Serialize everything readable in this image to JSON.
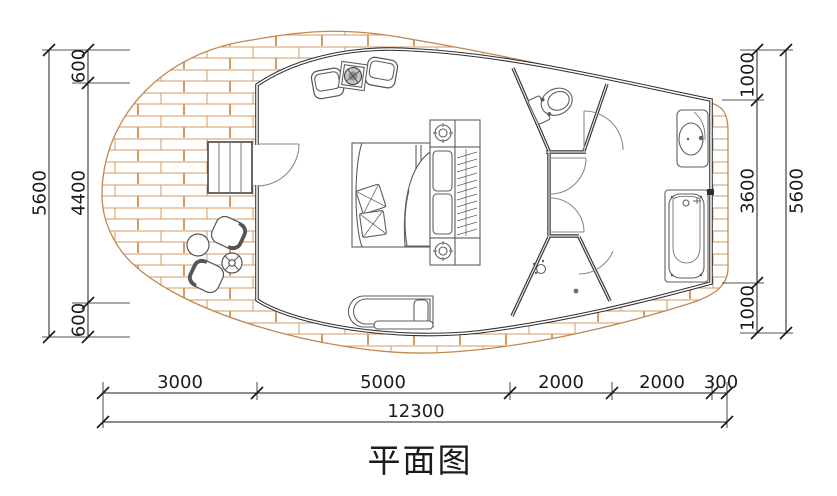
{
  "title": "平面图",
  "dimensions": {
    "left": {
      "overall": "5600",
      "segments": [
        "600",
        "4400",
        "600"
      ]
    },
    "right": {
      "overall": "5600",
      "segments": [
        "1000",
        "3600",
        "1000"
      ]
    },
    "bottom": {
      "overall": "12300",
      "segments": [
        "3000",
        "5000",
        "2000",
        "2000",
        "300"
      ]
    }
  },
  "colors": {
    "brick_line": "#d59a62",
    "outer_outline": "#c08850",
    "wall": "#2f2f2f",
    "furniture_line": "#5f5f5f",
    "dimension_line": "#1b1b1b"
  },
  "fixtures": [
    "entry-steps",
    "entry-door",
    "double-bed",
    "pillow",
    "blanket",
    "nightstand-lamp",
    "wardrobe-hangers",
    "armchair",
    "fire-table",
    "daybed",
    "toilet",
    "washbasin",
    "bathtub",
    "shower-head",
    "floor-drain",
    "terrace-round-table",
    "terrace-cross-table",
    "terrace-tub-chair"
  ]
}
